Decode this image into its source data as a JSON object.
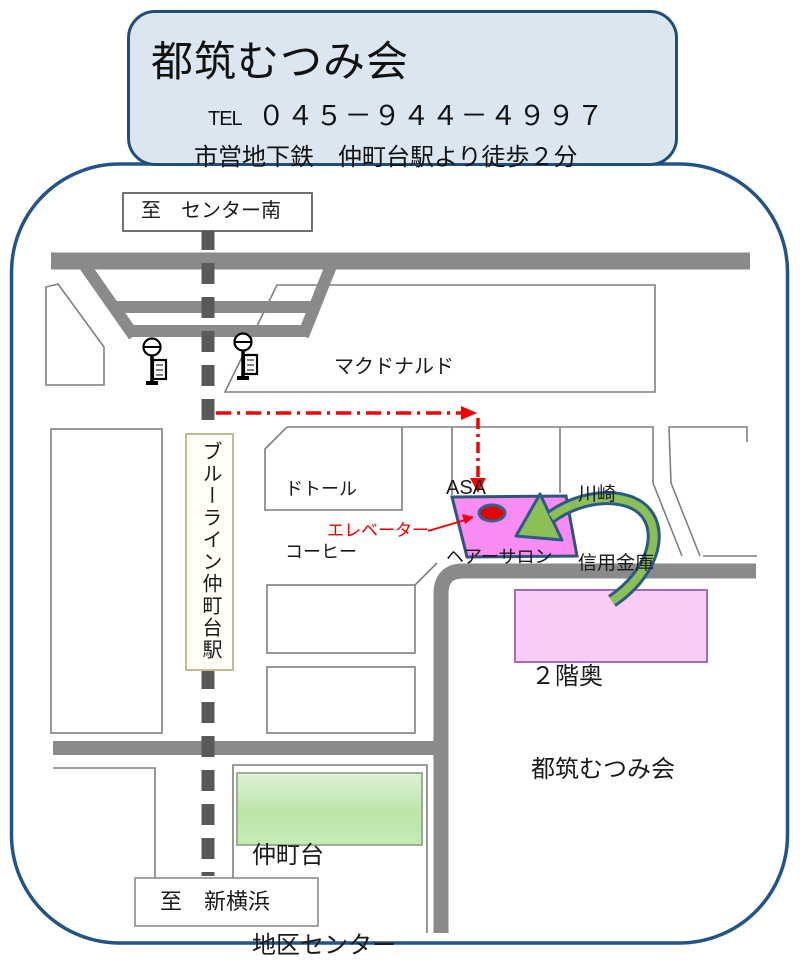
{
  "header": {
    "title": "都筑むつみ会",
    "tel_label": "TEL",
    "tel_number": "０４５－９４４－４９９７",
    "access": "市営地下鉄　仲町台駅より徒歩２分"
  },
  "signs": {
    "to_center_minami": "至　センター南",
    "to_shin_yokohama": "至　新横浜"
  },
  "station": {
    "name": "ブルーライン仲町台駅"
  },
  "buildings": {
    "mcdonalds": "マクドナルド",
    "doutor": {
      "line1": "ドトール",
      "line2": "コーヒー"
    },
    "asa": {
      "line1": "ASA",
      "line2": "ヘアーサロン"
    },
    "kawasaki": {
      "line1": "川崎",
      "line2": "信用金庫"
    }
  },
  "route": {
    "elevator_label": "エレベーター"
  },
  "destination": {
    "line1": "２階奥",
    "line2": "都筑むつみ会"
  },
  "community_center": {
    "line1": "仲町台",
    "line2": "地区センター"
  },
  "colors": {
    "map-border": "#24538A",
    "header-fill": "#DCE6F1",
    "header-border": "#1F4E79",
    "road": "#8A8A8A",
    "railway": "#595959",
    "block-outline": "#7F7F7F",
    "route-red": "#F40000",
    "pink-fill": "#F98CF2",
    "pink-border": "#2F5579",
    "marker-red": "#E60000",
    "marker-ring": "#2E6394",
    "label-pink-fill": "#FACBF5",
    "label-pink-border": "#A56BC0",
    "arrow-green": "#8CBF56",
    "arrow-outline": "#2B5A87",
    "green-light": "#DFF2D8",
    "green-dark": "#BCE5A8",
    "station-border": "#C5BA92"
  }
}
